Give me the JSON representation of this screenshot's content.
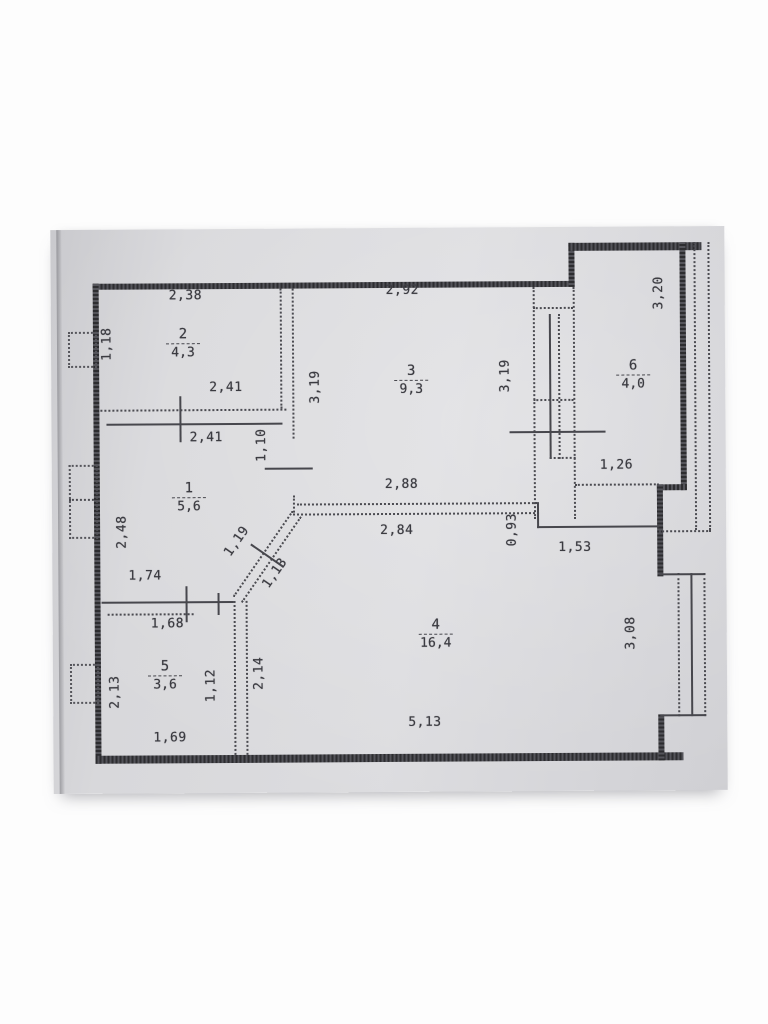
{
  "document": {
    "kind": "apartment floor plan scan"
  },
  "rooms": [
    {
      "number": "1",
      "area": "5,6"
    },
    {
      "number": "2",
      "area": "4,3"
    },
    {
      "number": "3",
      "area": "9,3"
    },
    {
      "number": "4",
      "area": "16,4"
    },
    {
      "number": "5",
      "area": "3,6"
    },
    {
      "number": "6",
      "area": "4,0"
    }
  ],
  "dims": {
    "room2_top": "2,38",
    "room3_top": "2,92",
    "room2_left": "1,18",
    "room2_inner": "2,41",
    "room1_top": "2,41",
    "door_width": "1,10",
    "room3_left": "3,19",
    "room3_right": "3,19",
    "room6_side": "3,20",
    "room1_left": "2,48",
    "room3_bottom": "2,88",
    "room4_top": "2,84",
    "step_height": "0,93",
    "step_width": "1,53",
    "room6_bottom": "1,26",
    "room1_bottom": "1,74",
    "room5_top": "1,68",
    "room5_bottom": "1,69",
    "room5_left": "2,13",
    "room5_right": "1,12",
    "corridor_height": "2,14",
    "diag_upper": "1,19",
    "diag_lower": "1,13",
    "room4_bottom": "5,13",
    "room4_right": "3,08"
  },
  "colors": {
    "paper": "#d7d7da",
    "ink": "#3b3b41",
    "wall": "#2d2d30"
  }
}
